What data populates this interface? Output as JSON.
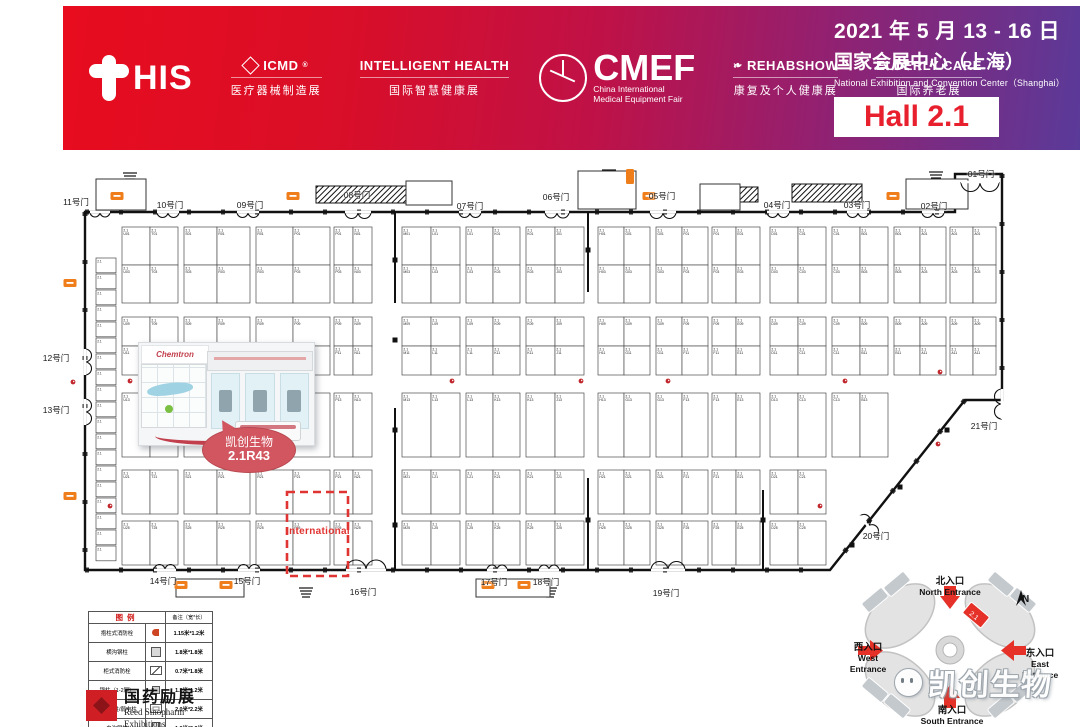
{
  "header": {
    "this_text": "HIS",
    "exhibitions": [
      {
        "name": "ICMD",
        "reg": "®",
        "sub": "医疗器械制造展",
        "icon": "cube-icon"
      },
      {
        "name": "INTELLIGENT HEALTH",
        "reg": "",
        "sub": "国际智慧健康展",
        "icon": ""
      },
      {
        "name": "CMEF",
        "reg": "®",
        "sub1": "China International",
        "sub2": "Medical Equipment Fair",
        "icon": "emblem-icon"
      },
      {
        "name": "REHABSHOW",
        "reg": "",
        "sub": "康复及个人健康展",
        "icon": "butterfly-icon"
      },
      {
        "name": "ELDERLY CARE",
        "reg": "",
        "sub": "国际养老展",
        "icon": ""
      }
    ],
    "date_line": "2021 年 5 月 13 - 16 日",
    "venue_cn": "国家会展中心（上海）",
    "venue_en": "National Exhibition and Convention Center（Shanghai）",
    "hall_label": "Hall 2.1"
  },
  "floorplan": {
    "booth_prefix": "2.1",
    "international_label": "International",
    "highlight": {
      "company": "凯创生物",
      "booth": "2.1R43",
      "render_logo": "Chemtron"
    },
    "outline": [
      [
        85,
        212
      ],
      [
        955,
        212
      ],
      [
        955,
        174
      ],
      [
        1002,
        174
      ],
      [
        1002,
        400
      ],
      [
        965,
        400
      ],
      [
        830,
        570
      ],
      [
        85,
        570
      ]
    ],
    "walls": [
      [
        395,
        212,
        395,
        303
      ],
      [
        395,
        408,
        395,
        570
      ],
      [
        588,
        212,
        588,
        292
      ],
      [
        588,
        478,
        588,
        570
      ],
      [
        763,
        490,
        763,
        570
      ]
    ],
    "international_box": [
      287,
      492,
      61,
      84
    ],
    "gates": [
      {
        "label": "11号门",
        "x": 76,
        "y": 196
      },
      {
        "label": "10号门",
        "x": 170,
        "y": 199
      },
      {
        "label": "09号门",
        "x": 250,
        "y": 199
      },
      {
        "label": "08号门",
        "x": 357,
        "y": 189
      },
      {
        "label": "07号门",
        "x": 470,
        "y": 200
      },
      {
        "label": "06号门",
        "x": 556,
        "y": 191
      },
      {
        "label": "05号门",
        "x": 662,
        "y": 190
      },
      {
        "label": "04号门",
        "x": 777,
        "y": 199
      },
      {
        "label": "03号门",
        "x": 857,
        "y": 199
      },
      {
        "label": "02号门",
        "x": 934,
        "y": 200
      },
      {
        "label": "01号门",
        "x": 981,
        "y": 168
      },
      {
        "label": "12号门",
        "x": 56,
        "y": 352
      },
      {
        "label": "13号门",
        "x": 56,
        "y": 404
      },
      {
        "label": "21号门",
        "x": 984,
        "y": 420
      },
      {
        "label": "20号门",
        "x": 876,
        "y": 530
      },
      {
        "label": "14号门",
        "x": 163,
        "y": 575
      },
      {
        "label": "15号门",
        "x": 247,
        "y": 575
      },
      {
        "label": "16号门",
        "x": 363,
        "y": 586
      },
      {
        "label": "17号门",
        "x": 494,
        "y": 576
      },
      {
        "label": "18号门",
        "x": 546,
        "y": 576
      },
      {
        "label": "19号门",
        "x": 666,
        "y": 587
      }
    ],
    "doors": [
      [
        100,
        212,
        0,
        20
      ],
      [
        168,
        212,
        0,
        22
      ],
      [
        248,
        212,
        0,
        22
      ],
      [
        358,
        212,
        0,
        26
      ],
      [
        470,
        212,
        0,
        22
      ],
      [
        557,
        212,
        0,
        24
      ],
      [
        663,
        212,
        0,
        26
      ],
      [
        778,
        212,
        0,
        22
      ],
      [
        858,
        212,
        0,
        22
      ],
      [
        933,
        212,
        0,
        22
      ],
      [
        980,
        182,
        0,
        38
      ],
      [
        85,
        362,
        -90,
        26
      ],
      [
        85,
        412,
        -90,
        26
      ],
      [
        1002,
        404,
        90,
        30
      ],
      [
        868,
        526,
        -128,
        26
      ],
      [
        165,
        570,
        180,
        22
      ],
      [
        249,
        570,
        180,
        22
      ],
      [
        366,
        570,
        180,
        40
      ],
      [
        497,
        570,
        180,
        20
      ],
      [
        549,
        570,
        180,
        20
      ],
      [
        668,
        570,
        180,
        34
      ]
    ],
    "grid": {
      "row_bands": [
        {
          "y": 227,
          "heights": [
            38,
            38
          ]
        },
        {
          "y": 317,
          "heights": [
            29,
            29
          ]
        },
        {
          "y": 393,
          "heights": [
            64
          ]
        },
        {
          "y": 470,
          "heights": [
            44
          ]
        },
        {
          "y": 521,
          "heights": [
            44
          ]
        }
      ],
      "row_codes": [
        "01",
        "03",
        "09",
        "11",
        "13",
        "21",
        "25"
      ],
      "col_bands": [
        {
          "x": 122,
          "sub": [
            28,
            28
          ],
          "letters": [
            "U",
            "T"
          ],
          "max_bands": 5
        },
        {
          "x": 184,
          "sub": [
            33,
            33
          ],
          "letters": [
            "S",
            "R"
          ],
          "max_bands": 5
        },
        {
          "x": 256,
          "sub": [
            37,
            37
          ],
          "letters": [
            "R",
            "P"
          ],
          "max_bands": 5
        },
        {
          "x": 334,
          "sub": [
            19,
            19
          ],
          "letters": [
            "P",
            "N"
          ],
          "max_bands": 5
        },
        {
          "x": 402,
          "sub": [
            29,
            29
          ],
          "letters": [
            "M",
            "L"
          ],
          "max_bands": 5
        },
        {
          "x": 466,
          "sub": [
            27,
            27
          ],
          "letters": [
            "L",
            "K"
          ],
          "max_bands": 5
        },
        {
          "x": 526,
          "sub": [
            29,
            29
          ],
          "letters": [
            "K",
            "J"
          ],
          "max_bands": 5
        },
        {
          "x": 598,
          "sub": [
            26,
            26
          ],
          "letters": [
            "H",
            "G"
          ],
          "max_bands": 5
        },
        {
          "x": 656,
          "sub": [
            26,
            26
          ],
          "letters": [
            "G",
            "F"
          ],
          "max_bands": 5
        },
        {
          "x": 712,
          "sub": [
            24,
            24
          ],
          "letters": [
            "F",
            "E"
          ],
          "max_bands": 5
        },
        {
          "x": 770,
          "sub": [
            28,
            28
          ],
          "letters": [
            "D",
            "C"
          ],
          "max_bands": 5
        },
        {
          "x": 832,
          "sub": [
            28,
            28
          ],
          "letters": [
            "C",
            "B"
          ],
          "max_bands": 3
        },
        {
          "x": 894,
          "sub": [
            26,
            26
          ],
          "letters": [
            "B",
            "A"
          ],
          "max_bands": 2
        },
        {
          "x": 950,
          "sub": [
            23,
            23
          ],
          "letters": [
            "A",
            "A"
          ],
          "max_bands": 2
        }
      ],
      "left_strip": {
        "x": 96,
        "w": 20,
        "y": 258,
        "cell_h": 16,
        "count": 19
      }
    },
    "hydrants": [
      [
        130,
        381
      ],
      [
        290,
        381
      ],
      [
        452,
        381
      ],
      [
        581,
        381
      ],
      [
        668,
        381
      ],
      [
        845,
        381
      ],
      [
        940,
        372
      ],
      [
        110,
        506
      ],
      [
        938,
        444
      ],
      [
        73,
        382
      ],
      [
        820,
        506
      ]
    ],
    "columns": [
      [
        395,
        260
      ],
      [
        395,
        340
      ],
      [
        395,
        430
      ],
      [
        395,
        525
      ],
      [
        588,
        250
      ],
      [
        588,
        520
      ],
      [
        852,
        545
      ],
      [
        900,
        487
      ],
      [
        947,
        430
      ],
      [
        763,
        520
      ]
    ],
    "facility_icons": [
      [
        117,
        196
      ],
      [
        293,
        196
      ],
      [
        649,
        196
      ],
      [
        893,
        196
      ],
      [
        181,
        585
      ],
      [
        226,
        585
      ],
      [
        488,
        585
      ],
      [
        524,
        585
      ],
      [
        70,
        283
      ],
      [
        70,
        496
      ]
    ],
    "facility_icon_v": [
      626,
      169
    ],
    "escalators": [
      [
        316,
        186,
        102,
        17
      ],
      [
        720,
        187,
        38,
        15
      ],
      [
        792,
        184,
        70,
        18
      ]
    ],
    "stairs": [
      [
        130,
        173
      ],
      [
        609,
        170
      ],
      [
        936,
        172
      ],
      [
        306,
        588
      ],
      [
        550,
        588
      ]
    ],
    "service_rooms": [
      [
        96,
        179,
        50,
        31
      ],
      [
        406,
        181,
        46,
        24
      ],
      [
        578,
        171,
        58,
        38
      ],
      [
        700,
        184,
        40,
        26
      ],
      [
        906,
        179,
        62,
        30
      ],
      [
        176,
        579,
        68,
        18
      ],
      [
        476,
        579,
        74,
        18
      ]
    ]
  },
  "legend": {
    "title": "图例",
    "note_header": "备注（宽*长）",
    "rows": [
      {
        "label": "抱柱式消防栓",
        "size": "1.15米*1.2米",
        "icon": "hydrant-red"
      },
      {
        "label": "横沟钢柱",
        "size": "1.8米*1.8米",
        "icon": "square"
      },
      {
        "label": "柜式消防栓",
        "size": "0.7米*1.8米",
        "icon": "diagonal"
      },
      {
        "label": "钢柱（1-2层）",
        "size": "1.2米*1.2米",
        "icon": "square-small"
      },
      {
        "label": "强电钢柱/弱电柱",
        "size": "2.0米*2.2米",
        "icon": "square-box"
      },
      {
        "label": "电沟钢柱",
        "size": "1.8米*2.3米",
        "icon": "square-tall"
      }
    ]
  },
  "organizer": {
    "name_cn": "国药励展",
    "name_en1": "Reed Sinopharm",
    "name_en2": "Exhibitions"
  },
  "venue_map": {
    "compass": "N",
    "hall_mark": "2.1",
    "entrances": [
      {
        "cn": "北入口",
        "en": "North Entrance",
        "pos": [
          902,
          576
        ],
        "w": 96
      },
      {
        "cn": "西入口",
        "en": "West Entrance",
        "pos": [
          842,
          642
        ],
        "w": 52
      },
      {
        "cn": "东入口",
        "en": "East Entrance",
        "pos": [
          1014,
          648
        ],
        "w": 52
      },
      {
        "cn": "南入口",
        "en": "South Entrance",
        "pos": [
          904,
          705
        ],
        "w": 96
      }
    ]
  },
  "watermark": "凯创生物"
}
